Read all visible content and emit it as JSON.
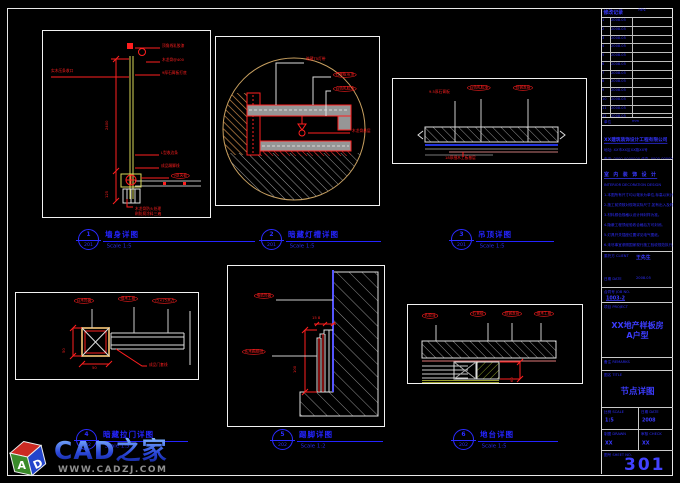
{
  "views": [
    {
      "num": "1",
      "sheet": "201",
      "title": "墙身详图",
      "scale": "Scale 1:5",
      "ann": {
        "left": "实木压条收口",
        "top1": "顶角线乳胶漆",
        "top2": "木龙骨@400",
        "top3": "9厚石膏板打底",
        "mid1": "L型收边条",
        "mid2": "成品踢脚线",
        "oval1": "9厚夹板",
        "bot1": "木龙骨防火处理",
        "bot2": "刷防腐涂料三遍",
        "dim1": "2400",
        "dim2": "125"
      }
    },
    {
      "num": "2",
      "sheet": "201",
      "title": "暗藏灯槽详图",
      "scale": "Scale 1:5",
      "ann": {
        "top": "暗藏T5灯带",
        "oval1": "石膏板吊顶",
        "oval2": "白色乳胶漆",
        "right": "木龙骨基层"
      }
    },
    {
      "num": "3",
      "sheet": "201",
      "title": "吊顶详图",
      "scale": "Scale 1:5",
      "ann": {
        "left": "9.5厚石膏板",
        "oval1": "白色乳胶漆",
        "oval2": "轻钢龙骨",
        "bottom": "18厚细木工板基层"
      }
    },
    {
      "num": "4",
      "sheet": "202",
      "title": "暗藏拉门详图",
      "scale": "Scale 1:5",
      "ann": {
        "oval1": "白木饰面",
        "oval2": "细木工板",
        "oval3": "25×25木方",
        "label": "成品门套线",
        "dim1": "50",
        "dim2": "50"
      }
    },
    {
      "num": "5",
      "sheet": "202",
      "title": "踢脚详图",
      "scale": "Scale 1:2",
      "ann": {
        "oval1": "墙纸饰面",
        "oval2": "实木踢脚线",
        "dim1": "100",
        "dim2": "15 8"
      }
    },
    {
      "num": "6",
      "sheet": "202",
      "title": "地台详图",
      "scale": "Scale 1:5",
      "ann": {
        "oval1": "乳胶漆",
        "oval2": "石膏板",
        "oval3": "轻钢龙骨",
        "oval4": "细木工板",
        "dim1": "60"
      }
    }
  ],
  "titleblock": {
    "rev_header_left": "修改记录",
    "rev_header_right": "REV.",
    "rev_rows": [
      {
        "n": "1",
        "d": "2008.05"
      },
      {
        "n": "2",
        "d": "2008.05"
      },
      {
        "n": "3",
        "d": "2008.05"
      },
      {
        "n": "4",
        "d": "2008.05"
      },
      {
        "n": "5",
        "d": "2008.05"
      },
      {
        "n": "6",
        "d": "2008.05"
      },
      {
        "n": "7",
        "d": "2008.05"
      },
      {
        "n": "8",
        "d": "2008.05"
      },
      {
        "n": "9",
        "d": "2008.05"
      },
      {
        "n": "10",
        "d": "2008.05"
      },
      {
        "n": "11",
        "d": "2008.05"
      },
      {
        "n": "12",
        "d": "2008.05"
      },
      {
        "n": "13",
        "d": "2008.05"
      }
    ],
    "unit_left": "单位",
    "unit_right": "mm",
    "company_name": "XX建筑装饰设计工程有限公司",
    "company_addr": "地址: XX市XX区XX路XX号",
    "company_tel": "电话: 0000-0000000  传真: 0000-0000000",
    "brand_row": "室 内 装 饰 设 计",
    "notes_sub": "INTERIOR DECORATION DESIGN",
    "notes": [
      "1.本图所有尺寸均以毫米为单位,标高以米计。",
      "2.施工前须核对现场实际尺寸,如有出入及时反馈。",
      "3.材料颜色规格以设计师封样为准。",
      "4.隐蔽工程须经验收合格后方可封闭。",
      "5.灯具开关插座位置详见电气图纸。",
      "6.未尽事宜参照国家现行施工验收规范执行。"
    ],
    "client_label": "委托方 CLIENT",
    "client_value": "王先生",
    "date_label": "日期 DATE",
    "date_value": "2008.05",
    "job_label": "合同号 JOB NO.",
    "job_value": "1003-2",
    "project_label": "项目 PROJECT",
    "project_name1": "XX地产样板房",
    "project_name2": "A户型",
    "remarks_label": "备注 REMARKS",
    "title_label": "图名 TITLE",
    "title_value": "节点详图",
    "scale_label": "比例 SCALE",
    "scale_value": "1:5",
    "date2_label": "日期 DATE",
    "date2_value": "2008",
    "drawn_label": "制图 DRAWN",
    "drawn_value": "XX",
    "check_label": "审核 CHECK",
    "check_value": "XX",
    "sheetno_label": "图号 SHEET NO.",
    "sheetno_value": "301"
  },
  "watermark": {
    "brand": "CAD之家",
    "url": "WWW.CADZJ.COM",
    "cube": [
      "A",
      "D"
    ]
  },
  "colors": {
    "annotation_red": "#ff1f1f",
    "label_blue": "#2424ff",
    "line_yellow": "#d8d858",
    "hatch_gray": "#9a9a9a",
    "tan": "#c8a060",
    "blue_line": "#2233dd"
  }
}
